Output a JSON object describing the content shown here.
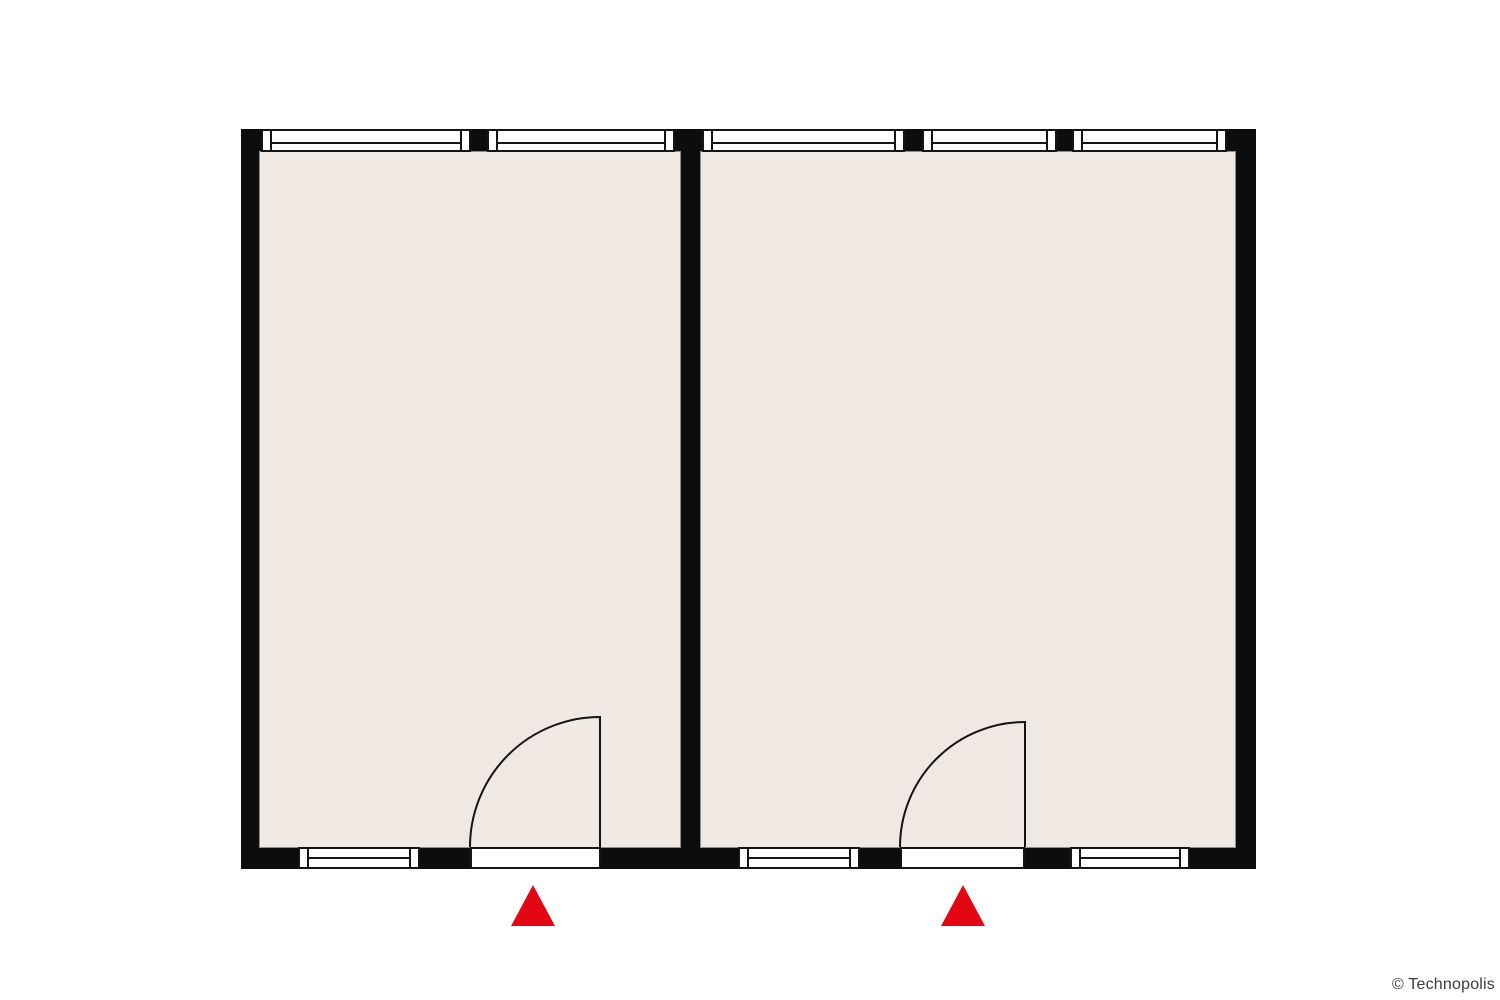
{
  "floorplan": {
    "colors": {
      "wall": "#0d0d0d",
      "room-fill": "#f0e9e3",
      "window-fill": "#ffffff",
      "line": "#141414",
      "outline": "#8e8e8e",
      "marker": "#e30613",
      "text": "#3a3a3a"
    },
    "rooms": [
      {
        "id": "room-left"
      },
      {
        "id": "room-right"
      }
    ],
    "windows": {
      "top_wall_count": 5,
      "bottom_wall_count": 3
    },
    "doors": {
      "count": 2,
      "swing": "quarter-circle-inward"
    },
    "entrance_markers": [
      "entrance-icon-left",
      "entrance-icon-right"
    ]
  },
  "footer": {
    "copyright": "© Technopolis"
  }
}
